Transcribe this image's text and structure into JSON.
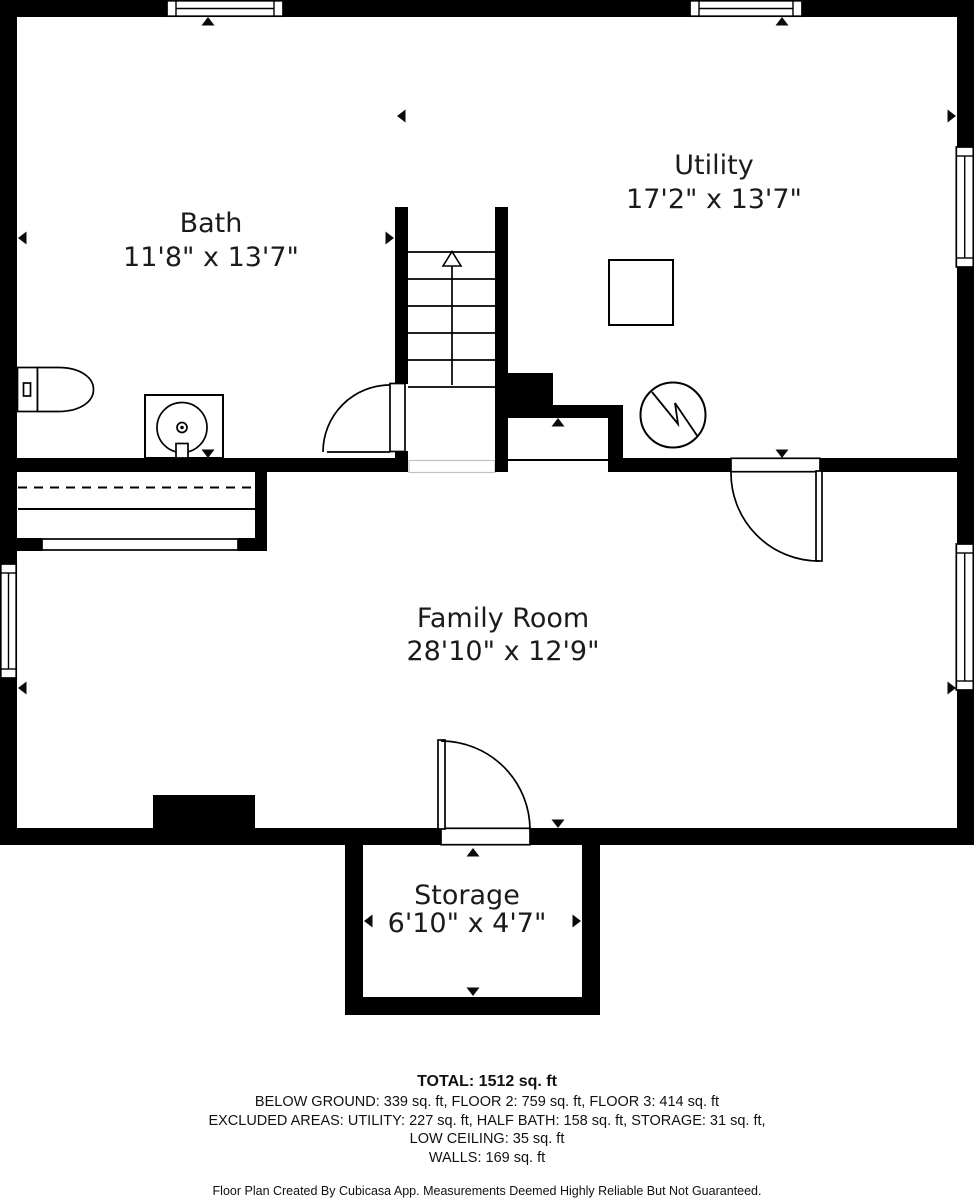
{
  "plan": {
    "rooms": [
      {
        "name": "Bath",
        "dims": "11'8\" x 13'7\""
      },
      {
        "name": "Utility",
        "dims": "17'2\" x 13'7\""
      },
      {
        "name": "Family Room",
        "dims": "28'10\" x 12'9\""
      },
      {
        "name": "Storage",
        "dims": "6'10\" x 4'7\""
      }
    ]
  },
  "summary": {
    "total": "TOTAL: 1512 sq. ft",
    "floors": "BELOW GROUND: 339 sq. ft, FLOOR 2: 759 sq. ft, FLOOR 3: 414 sq. ft",
    "excluded": "EXCLUDED AREAS: UTILITY: 227 sq. ft, HALF BATH: 158 sq. ft, STORAGE: 31 sq. ft,",
    "excluded2": "LOW CEILING: 35 sq. ft",
    "walls": "WALLS: 169 sq. ft"
  },
  "disclaimer": "Floor Plan Created By Cubicasa App. Measurements Deemed Highly Reliable But Not Guaranteed.",
  "colors": {
    "wall": "#000000",
    "background": "#ffffff",
    "text": "#1b1b1b"
  }
}
